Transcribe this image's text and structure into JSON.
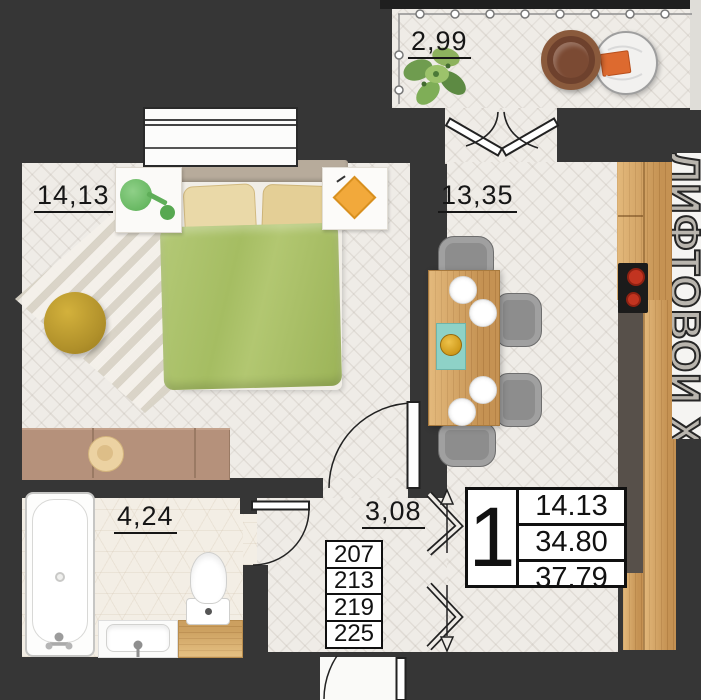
{
  "rooms": {
    "balcony": {
      "label": "2,99"
    },
    "bedroom": {
      "label": "14,13"
    },
    "kitchen_living": {
      "label": "13,35"
    },
    "hallway": {
      "label": "3,08"
    },
    "bathroom": {
      "label": "4,24"
    }
  },
  "info_box": {
    "room_count": "1",
    "values": [
      "14.13",
      "34.80",
      "37.79"
    ]
  },
  "apartment_numbers": [
    "207",
    "213",
    "219",
    "225"
  ],
  "common_area_text": "ЛИФТОВОЙ ХОЛЛ",
  "colors": {
    "wall": "#363636",
    "floor": "#efece7",
    "wood": "#d2a05f",
    "blanket_green": "#a9c06a",
    "burner_red": "#c23420",
    "book_orange": "#dd6a2f",
    "pouf_yellow": "#c2a233",
    "lamp_green": "#77c271"
  }
}
